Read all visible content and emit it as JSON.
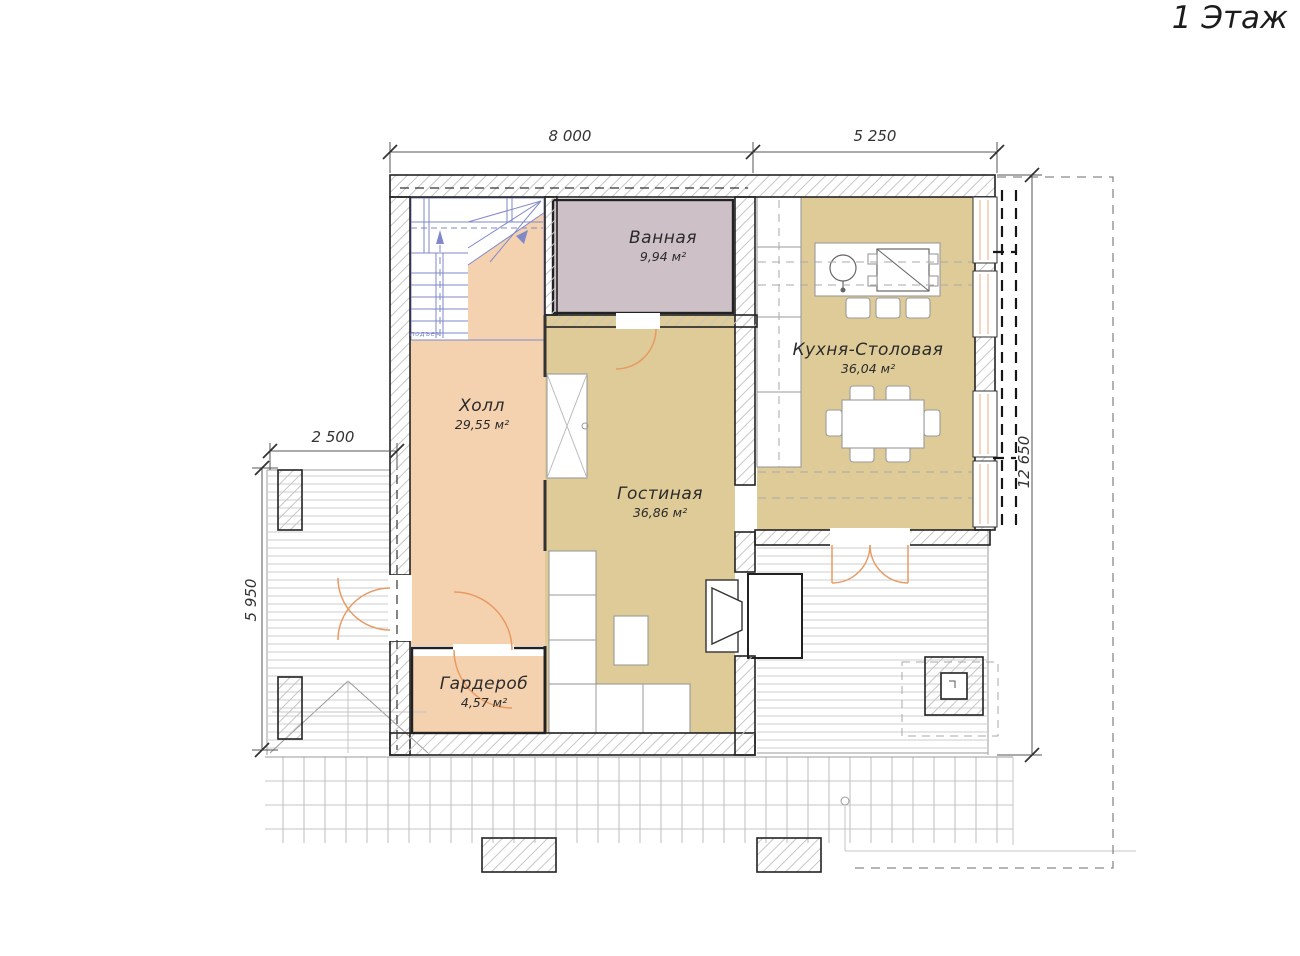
{
  "title": "1 Этаж",
  "dimensions": {
    "width_main": "8 000",
    "width_kitchen": "5 250",
    "terrace_width": "2 500",
    "terrace_depth": "5 950",
    "house_depth": "12 650"
  },
  "rooms": {
    "bathroom": {
      "name": "Ванная",
      "area": "9,94 м²"
    },
    "hall": {
      "name": "Холл",
      "area": "29,55 м²"
    },
    "kitchen": {
      "name": "Кухня-Столовая",
      "area": "36,04 м²"
    },
    "living": {
      "name": "Гостиная",
      "area": "36,86 м²"
    },
    "wardrobe": {
      "name": "Гардероб",
      "area": "4,57 м²"
    }
  },
  "stairs": {
    "label": "подъем"
  },
  "colors": {
    "wall": "#222222",
    "hatch": "#c6c6c6",
    "hall": "#f4d2b0",
    "living": "#decb97",
    "bathroom": "#cdc0c6",
    "stairs": "#8289c9",
    "door": "#e89a62",
    "dim": "#555555",
    "deck": "#cccccc"
  }
}
